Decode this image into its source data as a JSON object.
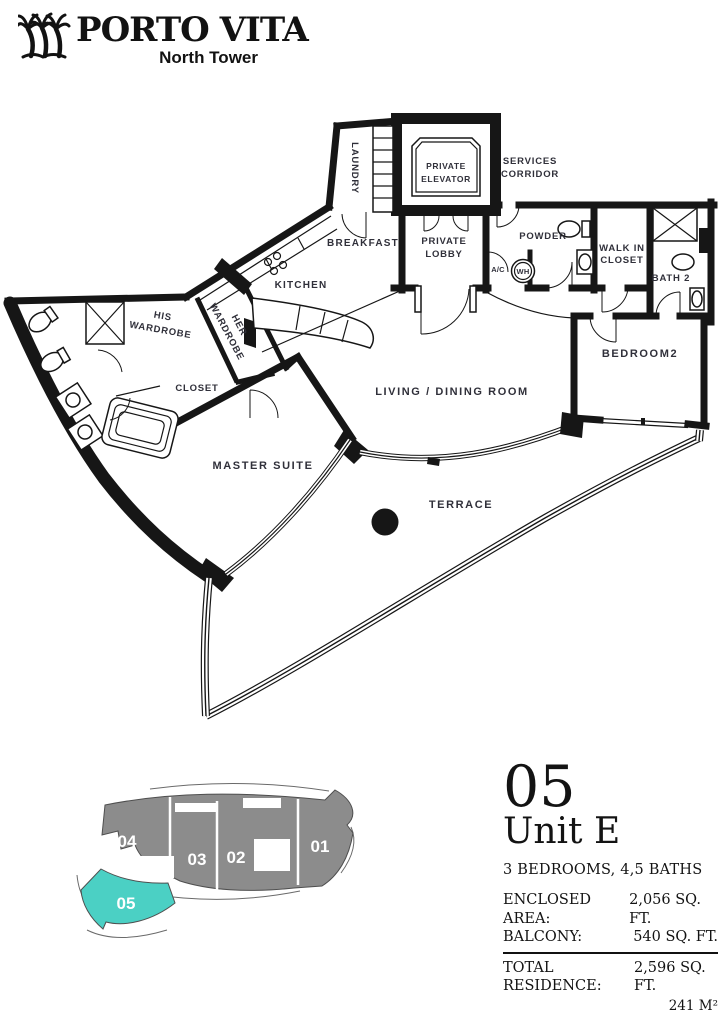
{
  "header": {
    "brand": "PORTO VITA",
    "subtitle": "North Tower"
  },
  "floor_plan": {
    "rooms": {
      "laundry": "LAUNDRY",
      "private_elevator": [
        "PRIVATE",
        "ELEVATOR"
      ],
      "services_corridor": [
        "SERVICES",
        "CORRIDOR"
      ],
      "breakfast": "BREAKFAST",
      "private_lobby": [
        "PRIVATE",
        "LOBBY"
      ],
      "powder": "POWDER",
      "ac": "A/C",
      "wh": "WH",
      "walk_in_closet": [
        "WALK IN",
        "CLOSET"
      ],
      "bath2": "BATH 2",
      "kitchen": "KITCHEN",
      "his_wardrobe": [
        "HIS",
        "WARDROBE"
      ],
      "her_wardrobe": [
        "HER",
        "WARDROBE"
      ],
      "closet": "CLOSET",
      "bedroom2": "BEDROOM2",
      "living_dining": "LIVING / DINING ROOM",
      "master_suite": "MASTER SUITE",
      "terrace": "TERRACE"
    },
    "wall_color": "#161616",
    "label_color": "#30303a"
  },
  "key_plan": {
    "units": [
      {
        "id": "01"
      },
      {
        "id": "02"
      },
      {
        "id": "03"
      },
      {
        "id": "04"
      },
      {
        "id": "05"
      }
    ],
    "highlighted_unit": "05",
    "building_color": "#8c8c8c",
    "highlight_color": "#4bd0c4"
  },
  "info_panel": {
    "unit_number": "05",
    "unit_name": "Unit E",
    "configuration": "3 BEDROOMS, 4,5 BATHS",
    "areas": [
      {
        "label": "ENCLOSED AREA:",
        "value": "2,056 SQ. FT."
      },
      {
        "label": "BALCONY:",
        "value": "540 SQ. FT."
      }
    ],
    "total_label": "TOTAL RESIDENCE:",
    "total_value": "2,596 SQ. FT.",
    "total_metric": "241 M²"
  }
}
